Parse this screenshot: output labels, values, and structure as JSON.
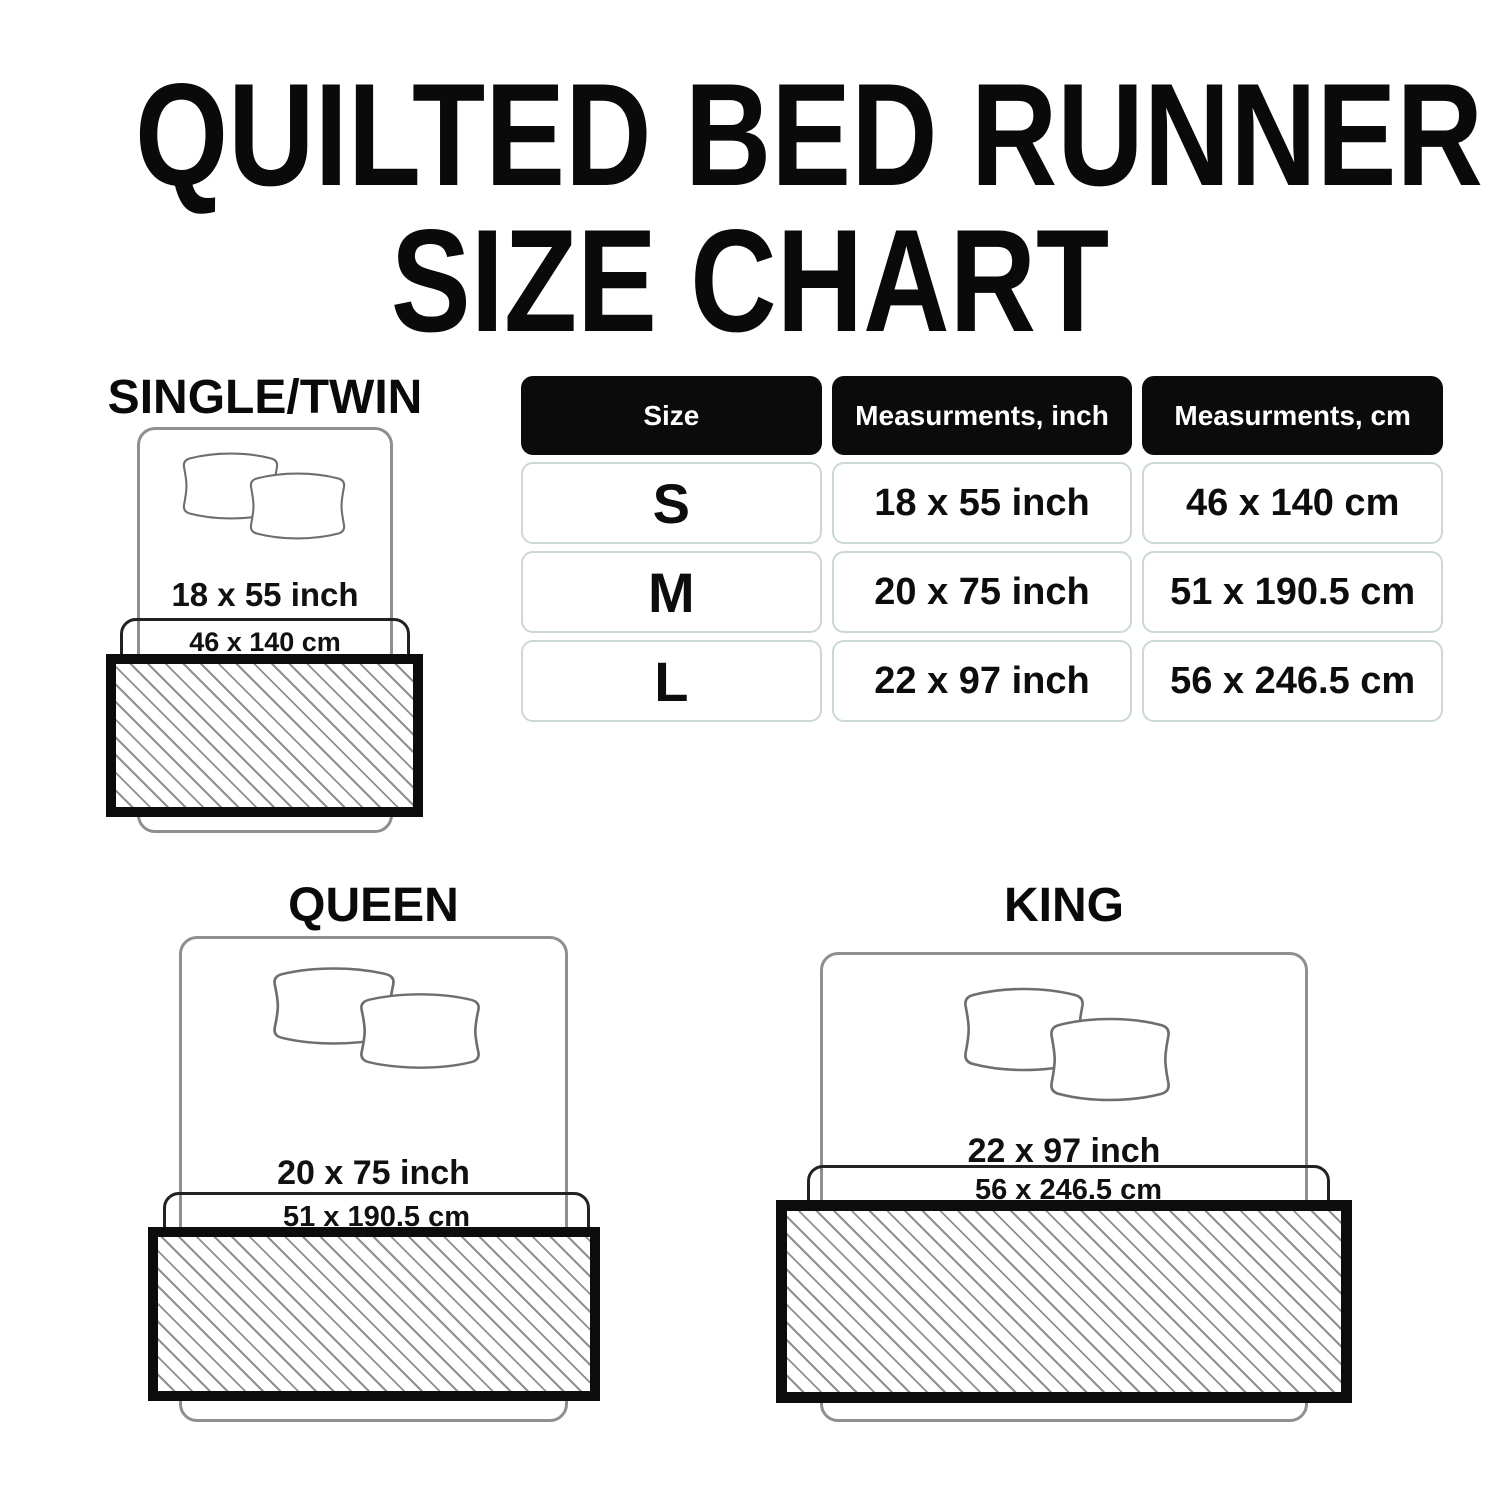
{
  "title": {
    "line1": "QUILTED BED RUNNER",
    "line2": "SIZE CHART"
  },
  "table": {
    "headers": {
      "size": "Size",
      "inch": "Measurments, inch",
      "cm": "Measurments, cm"
    },
    "rows": [
      {
        "size": "S",
        "inch": "18 x 55 inch",
        "cm": "46 x 140 cm"
      },
      {
        "size": "M",
        "inch": "20 x 75 inch",
        "cm": "51 x 190.5 cm"
      },
      {
        "size": "L",
        "inch": "22 x 97 inch",
        "cm": "56 x 246.5 cm"
      }
    ]
  },
  "diagrams": [
    {
      "label": "SINGLE/TWIN",
      "inch": "18 x 55 inch",
      "cm": "46 x 140 cm"
    },
    {
      "label": "QUEEN",
      "inch": "20 x 75 inch",
      "cm": "51 x 190.5 cm"
    },
    {
      "label": "KING",
      "inch": "22 x 97 inch",
      "cm": "56 x 246.5 cm"
    }
  ],
  "colors": {
    "header_bg": "#0b0b0b",
    "header_text": "#ffffff",
    "cell_border": "#ccd7da",
    "bed_outline": "#8f8f8f",
    "cm_box_border": "#222222",
    "runner_border": "#0c0c0c",
    "hatch_line": "#8f8f8f",
    "text": "#0d0d0d"
  },
  "chart_data": {
    "type": "table",
    "columns": [
      "Size",
      "Measurments, inch",
      "Measurments, cm"
    ],
    "rows": [
      [
        "S",
        "18 x 55 inch",
        "46 x 140 cm"
      ],
      [
        "M",
        "20 x 75 inch",
        "51 x 190.5 cm"
      ],
      [
        "L",
        "22 x 97 inch",
        "56 x 246.5 cm"
      ]
    ]
  }
}
